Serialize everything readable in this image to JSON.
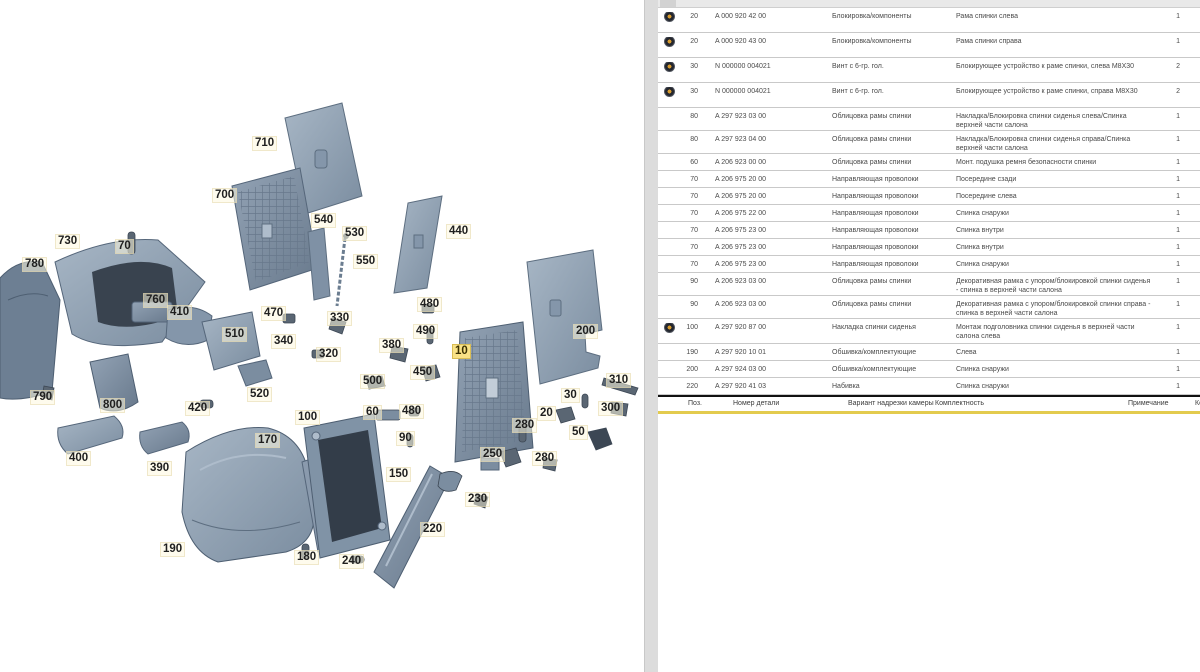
{
  "colors": {
    "accent_yellow": "#e3cb4e",
    "highlight_label": "#f9e286",
    "steel_light": "#a3b2c2",
    "steel_mid": "#8496aa",
    "steel_dark": "#5d6e80",
    "steel_darkest": "#3c4754",
    "icon_ring": "#23262e",
    "icon_dot": "#d79b2e"
  },
  "diagram": {
    "labels": [
      {
        "t": "710",
        "x": 252,
        "y": 136
      },
      {
        "t": "700",
        "x": 212,
        "y": 188
      },
      {
        "t": "730",
        "x": 55,
        "y": 234
      },
      {
        "t": "70",
        "x": 115,
        "y": 239
      },
      {
        "t": "780",
        "x": 22,
        "y": 257
      },
      {
        "t": "540",
        "x": 311,
        "y": 213
      },
      {
        "t": "530",
        "x": 342,
        "y": 226
      },
      {
        "t": "550",
        "x": 353,
        "y": 254
      },
      {
        "t": "440",
        "x": 446,
        "y": 224
      },
      {
        "t": "760",
        "x": 143,
        "y": 293
      },
      {
        "t": "410",
        "x": 167,
        "y": 305
      },
      {
        "t": "470",
        "x": 261,
        "y": 306
      },
      {
        "t": "330",
        "x": 327,
        "y": 311
      },
      {
        "t": "480",
        "x": 417,
        "y": 297
      },
      {
        "t": "490",
        "x": 413,
        "y": 324
      },
      {
        "t": "510",
        "x": 222,
        "y": 327
      },
      {
        "t": "340",
        "x": 271,
        "y": 334
      },
      {
        "t": "320",
        "x": 316,
        "y": 347
      },
      {
        "t": "380",
        "x": 379,
        "y": 338
      },
      {
        "t": "10",
        "x": 452,
        "y": 344,
        "hl": true
      },
      {
        "t": "200",
        "x": 573,
        "y": 324
      },
      {
        "t": "520",
        "x": 247,
        "y": 387
      },
      {
        "t": "500",
        "x": 360,
        "y": 374
      },
      {
        "t": "450",
        "x": 410,
        "y": 365
      },
      {
        "t": "30",
        "x": 561,
        "y": 388
      },
      {
        "t": "310",
        "x": 606,
        "y": 373
      },
      {
        "t": "300",
        "x": 598,
        "y": 401
      },
      {
        "t": "790",
        "x": 30,
        "y": 390
      },
      {
        "t": "800",
        "x": 100,
        "y": 398
      },
      {
        "t": "420",
        "x": 185,
        "y": 401
      },
      {
        "t": "60",
        "x": 363,
        "y": 405
      },
      {
        "t": "480",
        "x": 399,
        "y": 404
      },
      {
        "t": "100",
        "x": 295,
        "y": 410
      },
      {
        "t": "90",
        "x": 396,
        "y": 431
      },
      {
        "t": "20",
        "x": 537,
        "y": 406
      },
      {
        "t": "280",
        "x": 512,
        "y": 418
      },
      {
        "t": "50",
        "x": 569,
        "y": 425
      },
      {
        "t": "170",
        "x": 255,
        "y": 433
      },
      {
        "t": "250",
        "x": 480,
        "y": 447
      },
      {
        "t": "280",
        "x": 532,
        "y": 451
      },
      {
        "t": "400",
        "x": 66,
        "y": 451
      },
      {
        "t": "390",
        "x": 147,
        "y": 461
      },
      {
        "t": "150",
        "x": 386,
        "y": 467
      },
      {
        "t": "230",
        "x": 465,
        "y": 492
      },
      {
        "t": "190",
        "x": 160,
        "y": 542
      },
      {
        "t": "180",
        "x": 294,
        "y": 550
      },
      {
        "t": "240",
        "x": 339,
        "y": 554
      },
      {
        "t": "220",
        "x": 420,
        "y": 522
      }
    ]
  },
  "table": {
    "rows": [
      {
        "icon": true,
        "pos": "20",
        "part": "A 000 920 42 00",
        "name": "Блокировка/компоненты",
        "desc": "Рама спинки слева",
        "qty": "1"
      },
      {
        "icon": true,
        "pos": "20",
        "part": "A 000 920 43 00",
        "name": "Блокировка/компоненты",
        "desc": "Рама спинки справа",
        "qty": "1"
      },
      {
        "icon": true,
        "pos": "30",
        "part": "N 000000 004021",
        "name": "Винт с 6-гр. гол.",
        "desc": "Блокирующее устройство к раме спинки, слева M8X30",
        "qty": "2"
      },
      {
        "icon": true,
        "pos": "30",
        "part": "N 000000 004021",
        "name": "Винт с 6-гр. гол.",
        "desc": "Блокирующее устройство к раме спинки, справа M8X30",
        "qty": "2"
      },
      {
        "icon": false,
        "pos": "80",
        "part": "A 297 923 03 00",
        "name": "Облицовка рамы спинки",
        "desc": "Накладка/Блокировка спинки сиденья слева/Спинка верхней части салона",
        "qty": "1"
      },
      {
        "icon": false,
        "pos": "80",
        "part": "A 297 923 04 00",
        "name": "Облицовка рамы спинки",
        "desc": "Накладка/Блокировка спинки сиденья справа/Спинка верхней части салона",
        "qty": "1"
      },
      {
        "icon": false,
        "pos": "60",
        "part": "A 206 923 00 00",
        "name": "Облицовка рамы спинки",
        "desc": "Монт. подушка ремня безопасности спинки",
        "qty": "1"
      },
      {
        "icon": false,
        "pos": "70",
        "part": "A 206 975 20 00",
        "name": "Направляющая проволоки",
        "desc": "Посередине сзади",
        "qty": "1"
      },
      {
        "icon": false,
        "pos": "70",
        "part": "A 206 975 20 00",
        "name": "Направляющая проволоки",
        "desc": "Посередине слева",
        "qty": "1"
      },
      {
        "icon": false,
        "pos": "70",
        "part": "A 206 975 22 00",
        "name": "Направляющая проволоки",
        "desc": "Спинка снаружи",
        "qty": "1"
      },
      {
        "icon": false,
        "pos": "70",
        "part": "A 206 975 23 00",
        "name": "Направляющая проволоки",
        "desc": "Спинка внутри",
        "qty": "1"
      },
      {
        "icon": false,
        "pos": "70",
        "part": "A 206 975 23 00",
        "name": "Направляющая проволоки",
        "desc": "Спинка внутри",
        "qty": "1"
      },
      {
        "icon": false,
        "pos": "70",
        "part": "A 206 975 23 00",
        "name": "Направляющая проволоки",
        "desc": "Спинка снаружи",
        "qty": "1"
      },
      {
        "icon": false,
        "pos": "90",
        "part": "A 206 923 03 00",
        "name": "Облицовка рамы спинки",
        "desc": "Декоративная рамка с упором/блокировкой спинки сиденья - спинка в верхней части салона",
        "qty": "1"
      },
      {
        "icon": false,
        "pos": "90",
        "part": "A 206 923 03 00",
        "name": "Облицовка рамы спинки",
        "desc": "Декоративная рамка с упором/блокировкой спинки справа - спинка в верхней части салона",
        "qty": "1"
      },
      {
        "icon": true,
        "pos": "100",
        "part": "A 297 920 87 00",
        "name": "Накладка спинки сиденья",
        "desc": "Монтаж подголовника спинки сиденья в верхней части салона слева",
        "qty": "1"
      },
      {
        "icon": false,
        "pos": "190",
        "part": "A 297 920 10 01",
        "name": "Обшивка/комплектующие",
        "desc": "Слева",
        "qty": "1"
      },
      {
        "icon": false,
        "pos": "200",
        "part": "A 297 924 03 00",
        "name": "Обшивка/комплектующие",
        "desc": "Спинка снаружи",
        "qty": "1"
      },
      {
        "icon": false,
        "pos": "220",
        "part": "A 297 920 41 03",
        "name": "Набивка",
        "desc": "Спинка снаружи",
        "qty": "1"
      }
    ],
    "footer_header": {
      "pos": "Поз.",
      "part": "Номер детали",
      "variant": "Вариант надрезки камеры",
      "kompl": "Комплектность",
      "note": "Примечание",
      "qty_cut": "Кол."
    }
  }
}
